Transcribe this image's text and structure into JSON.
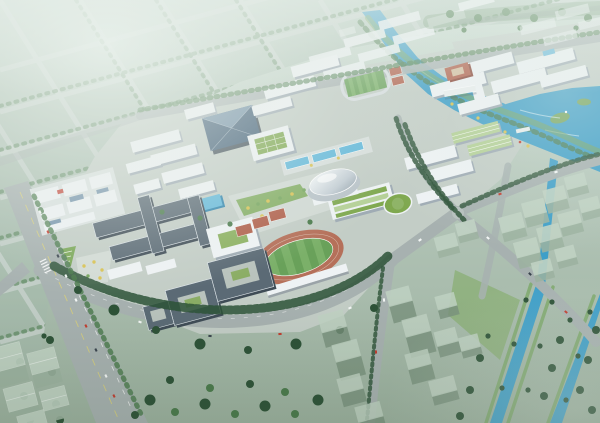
{
  "scene": {
    "title": "Aerial rendering of a university campus master plan",
    "setting": "bird's-eye perspective view in hazy daylight; detailed campus core surrounded by faded city context",
    "palette": {
      "cityRoad": "#c8d3ce",
      "road": "#a7b1b0",
      "roadLine": "#e8edec",
      "laneYellow": "#d9d079",
      "buildingTop": "#eef2f4",
      "buildingSide": "#9fabb4",
      "roofDark": "#5b6a75",
      "roofSide": "#3f4c56",
      "glassBlue": "#3c5a74",
      "glassLight": "#7795ad",
      "greenRoof": "#7fa84f",
      "greenRoofLight": "#b4d096",
      "domeSilver": "#dfe6ea",
      "lawn": "#7aa757",
      "plaza": "#dde4e0",
      "fieldGreen": "#69a15a",
      "fieldStripe": "#7bb069",
      "track": "#b5705a",
      "courtRed": "#b05f4a",
      "water": "#3f9fc8",
      "waterLight": "#62b8da",
      "waterDeep": "#2f84ad",
      "treeDark": "#2d5237",
      "treeMid": "#4a7a4b",
      "treeLight": "#74a45c",
      "shrubYellow": "#d9c252",
      "massingPale": "#c0d2c3",
      "massingSide": "#9cb2a0",
      "massingDark": "#78907c",
      "carRed": "#c23b2e",
      "carWhite": "#f4f7f6",
      "carDark": "#39434d"
    },
    "landmarks": [
      {
        "name": "faded-city-grid",
        "description": "hazy street grid with tree-lined green blocks, upper left"
      },
      {
        "name": "main-boulevard",
        "description": "wide avenue with traffic running down the left side"
      },
      {
        "name": "campus-entrance",
        "description": "west gate with lawn wedge and tree plaza"
      },
      {
        "name": "academic-complex",
        "description": "dark-roofed interconnected teaching buildings, center left"
      },
      {
        "name": "workshop-cluster",
        "description": "low courtyard workshop block with blue skylights, west"
      },
      {
        "name": "glass-library",
        "description": "dark blue faceted glass hall, upper center"
      },
      {
        "name": "green-grid-roof-hall",
        "description": "hall with planted grid roof beside the glass hall"
      },
      {
        "name": "central-dome-hall",
        "description": "silver elliptical dome auditorium at campus center"
      },
      {
        "name": "swimming-pool-row",
        "description": "row of blue pools along the central axis"
      },
      {
        "name": "green-terrace-building",
        "description": "terraced green-roof building with round green wing, east of the dome"
      },
      {
        "name": "stadium",
        "description": "oval terracotta running track with striped pitch, lower center"
      },
      {
        "name": "sports-courts",
        "description": "red courts beside the stadium"
      },
      {
        "name": "practice-field",
        "description": "small green pitch with pale track, upper right of center"
      },
      {
        "name": "red-courtyard-building",
        "description": "terracotta courtyard building in the northeast quarter"
      },
      {
        "name": "dormitory-rows",
        "description": "parallel white residential slabs along the top of campus"
      },
      {
        "name": "river-and-pond",
        "description": "cyan river widening into a landscaped pond on the right"
      },
      {
        "name": "canals",
        "description": "two tree-lined canals running to the lower right corner"
      },
      {
        "name": "future-massing-blocks",
        "description": "translucent pale building volumes right, bottom and lower left"
      }
    ]
  }
}
